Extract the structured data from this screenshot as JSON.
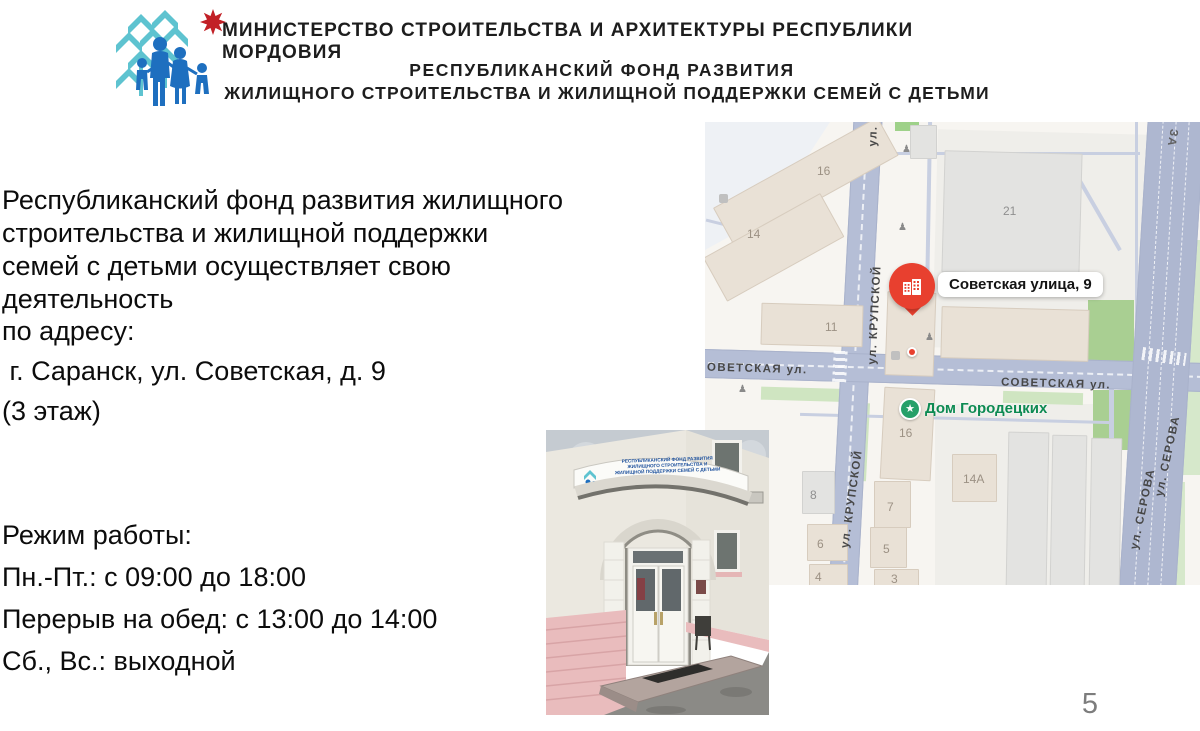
{
  "header": {
    "ministry": "МИНИСТЕРСТВО СТРОИТЕЛЬСТВА И АРХИТЕКТУРЫ РЕСПУБЛИКИ МОРДОВИЯ",
    "fund_line1": "РЕСПУБЛИКАНСКИЙ ФОНД РАЗВИТИЯ",
    "fund_line2": "ЖИЛИЩНОГО СТРОИТЕЛЬСТВА И ЖИЛИЩНОЙ ПОДДЕРЖКИ СЕМЕЙ С ДЕТЬМИ",
    "logo_colors": {
      "tree": "#5ec3d0",
      "family": "#1e6fbf",
      "star": "#c22026"
    }
  },
  "body": {
    "intro": "Республиканский фонд развития жилищного\nстроительства и жилищной поддержки\nсемей с детьми осуществляет свою\nдеятельность",
    "address_label": "по адресу:",
    "address": " г. Саранск, ул. Советская, д. 9",
    "floor": "(3 этаж)",
    "schedule_title": "Режим работы:",
    "schedule": [
      "Пн.-Пт.: с 09:00 до 18:00",
      "Перерыв на обед: с 13:00 до 14:00",
      "Сб., Вс.: выходной"
    ]
  },
  "map": {
    "pin_label": "Советская улица, 9",
    "poi_label": "Дом Городецких",
    "poi_star": "★",
    "streets": {
      "sovetskaya_left": "ОВЕТСКАЯ ул.",
      "sovetskaya": "СОВЕТСКАЯ ул.",
      "krupskoy": "ул. КРУПСКОЙ",
      "krupskoy_fragment": "ул.",
      "serova": "ул. СЕРОВА",
      "partial_top_right": "ЗА"
    },
    "buildings": {
      "b16_top": "16",
      "b14": "14",
      "b21": "21",
      "b11": "11",
      "b16_south": "16",
      "b14a": "14А",
      "b8": "8",
      "b7": "7",
      "b6": "6",
      "b5": "5",
      "b4": "4",
      "b3": "3"
    },
    "colors": {
      "pin_red": "#e8402f",
      "poi_green": "#0d8a52",
      "road": "#b5bed6"
    }
  },
  "photo": {
    "sign_text": "РЕСПУБЛИКАНСКИЙ ФОНД РАЗВИТИЯ\nЖИЛИЩНОГО СТРОИТЕЛЬСТВА И\nЖИЛИЩНОЙ ПОДДЕРЖКИ СЕМЕЙ С ДЕТЬМИ"
  },
  "page_number": "5"
}
